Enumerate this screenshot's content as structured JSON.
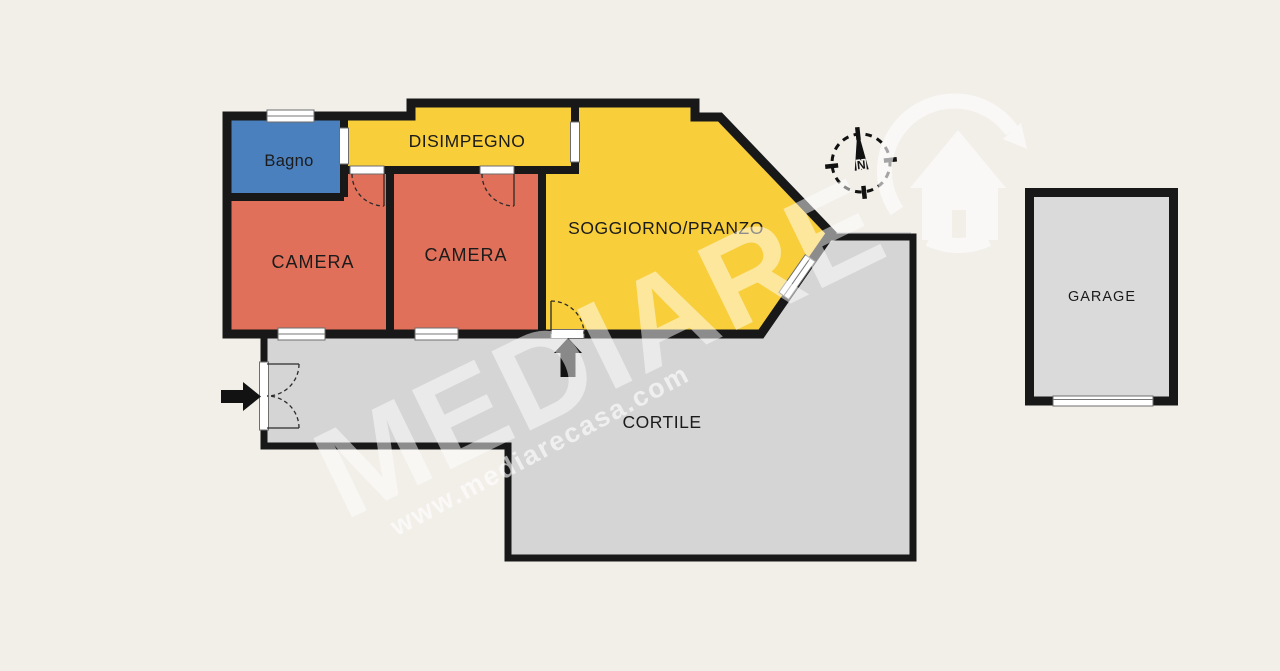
{
  "colors": {
    "background": "#F2EFE9",
    "walls": "#181818",
    "window_fill": "#FFFFFF",
    "watermark_white": "#FFFFFF"
  },
  "rooms": {
    "bagno": {
      "label": "Bagno",
      "color": "#4A80BE"
    },
    "disimpegno": {
      "label": "DISIMPEGNO",
      "color": "#F8CE3B"
    },
    "camera1": {
      "label": "CAMERA",
      "color": "#E0705A"
    },
    "camera2": {
      "label": "CAMERA",
      "color": "#E0705A"
    },
    "soggiorno": {
      "label": "SOGGIORNO/PRANZO",
      "color": "#F8CE3B"
    },
    "cortile": {
      "label": "CORTILE",
      "color": "#D5D5D5"
    },
    "garage": {
      "label": "GARAGE",
      "color": "#DADADA"
    }
  },
  "compass": {
    "north_label": "N"
  },
  "watermark": {
    "brand": "MEDIARE",
    "website": "www.mediarecasa.com"
  },
  "icons": {
    "entrance_arrow": "right-arrow",
    "secondary_entrance_arrow": "up-arrow",
    "compass": "compass-rose",
    "logo": "house-in-circular-arrow"
  }
}
